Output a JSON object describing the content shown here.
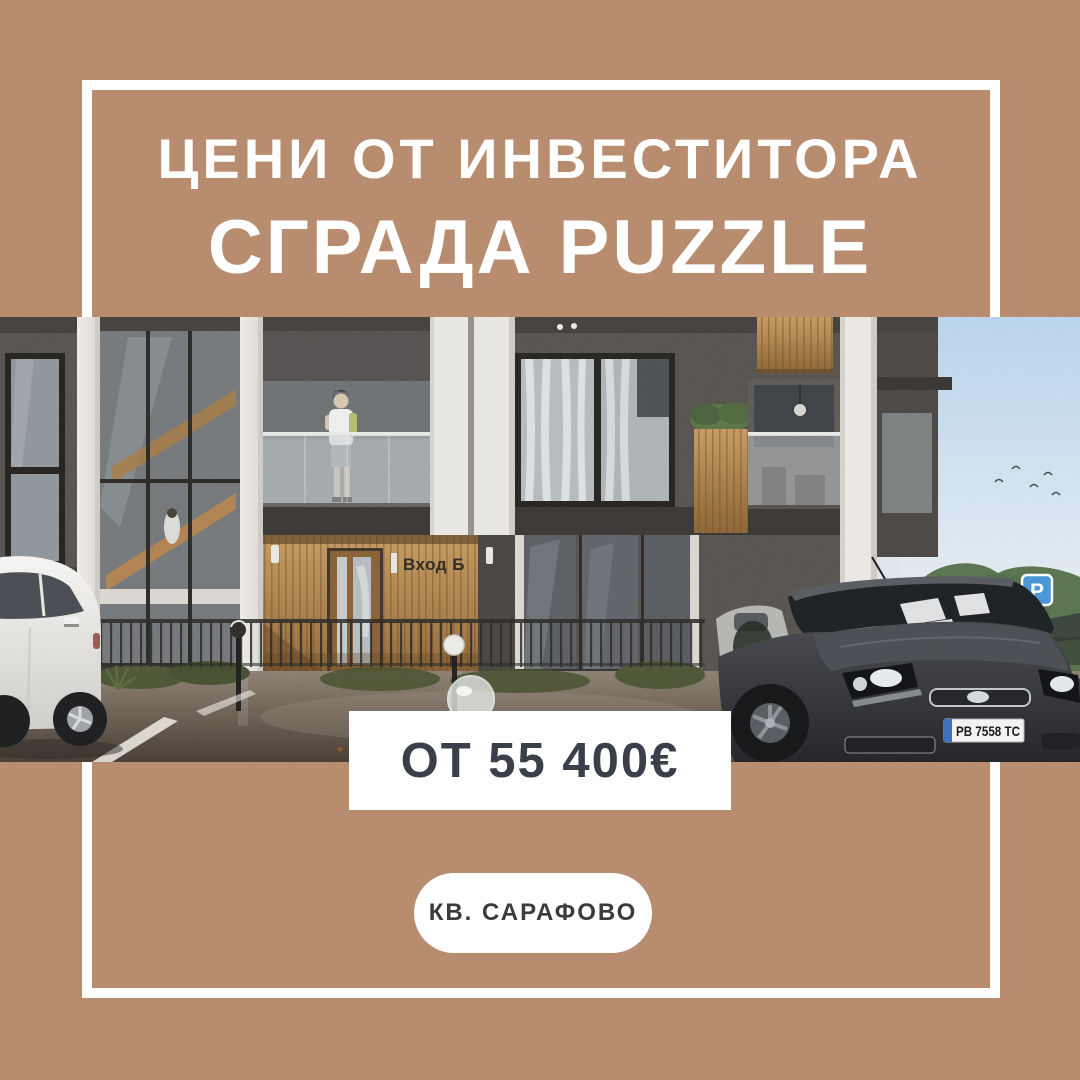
{
  "poster": {
    "colors": {
      "background": "#b88d6f",
      "frame": "#ffffff",
      "title": "#ffffff",
      "price_text": "#3a3f4a",
      "price_box_bg": "#ffffff",
      "location_text": "#3b3b3b",
      "location_pill_bg": "#ffffff",
      "parking_sign_blue": "#4796d8",
      "wood_accent": "#b9854e",
      "facade_dark": "#57534f"
    },
    "header": {
      "line1": "ЦЕНИ ОТ ИНВЕСТИТОРА",
      "line2": "СГРАДА PUZZLE"
    },
    "price": {
      "label": "ОТ 55 400€"
    },
    "location": {
      "label": "КВ. САРАФОВО"
    }
  },
  "photo": {
    "entrance_sign": "Вход Б",
    "license_plate": "PB 7558 TC",
    "parking_sign_letter": "P"
  }
}
